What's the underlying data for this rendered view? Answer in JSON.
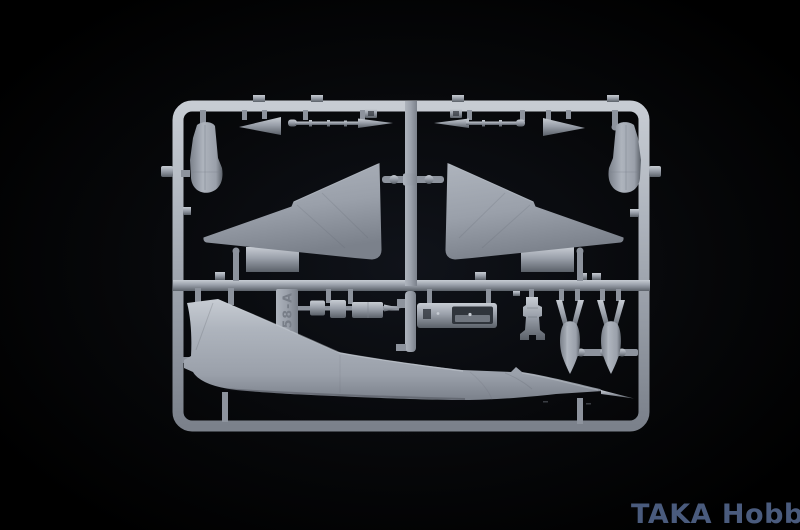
{
  "image": {
    "description": "Photograph of a light-grey injection-molded model aircraft sprue (delta-wing jet kit, runner A) on a black background",
    "subject": "plastic-model-kit-sprue"
  },
  "watermark": {
    "text": "TAKA Hobby"
  },
  "sprue": {
    "tag_text": "158-A",
    "section_top_parts": [
      "left-drop-tank-half",
      "left-stabilator",
      "left-probe-rod",
      "left-delta-wing",
      "wing-connector",
      "right-delta-wing",
      "right-probe-rod",
      "right-stabilator",
      "right-drop-tank-half"
    ],
    "section_bottom_parts": [
      "fuselage-half",
      "sprue-id-tag",
      "cockpit-small-parts",
      "cockpit-tub",
      "ejection-seat",
      "drop-tank-half-a",
      "drop-tank-half-b"
    ]
  },
  "colors": {
    "background": "#020304",
    "vignette": "#10131a",
    "plastic": "#9aa0aa",
    "plastic_light": "#aeb4bd",
    "plastic_highlight": "#c7ccd3",
    "plastic_dim": "#7b818b",
    "plastic_shadow": "#5b6169",
    "gate": "#8d939d",
    "slot_dark": "#30353c",
    "tag_text": "#787e88",
    "watermark": "#4a5b7d"
  }
}
